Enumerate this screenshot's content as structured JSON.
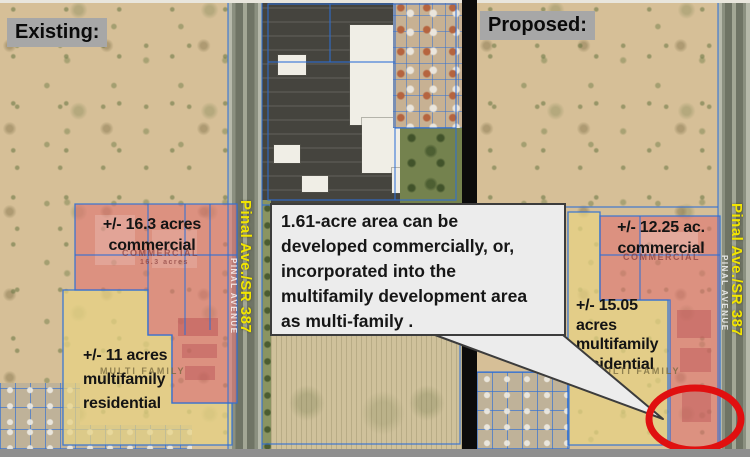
{
  "left_panel": {
    "title": "Existing:",
    "road_label": "Pinal Ave./SR 387",
    "street_label": "PINAL AVENUE",
    "commercial_label": {
      "line1": "+/- 16.3 acres",
      "line2": "commercial"
    },
    "multifamily_label": {
      "line1": "+/- 11 acres",
      "line2": "multifamily",
      "line3": "residential"
    },
    "map_annotations": {
      "commercial": "COMMERCIAL",
      "commercial_acres": "16.3 acres",
      "multifamily": "MULTI FAMILY"
    }
  },
  "right_panel": {
    "title": "Proposed:",
    "road_label": "Pinal Ave./SR 387",
    "street_label": "PINAL AVENUE",
    "commercial_label": {
      "line1": "+/- 12.25 ac.",
      "line2": "commercial"
    },
    "multifamily_label": {
      "line1": "+/- 15.05",
      "line2": "acres",
      "line3": "multifamily",
      "line4": "residential"
    },
    "map_annotations": {
      "commercial": "COMMERCIAL",
      "multifamily": "MULTI FAMILY"
    }
  },
  "callout": {
    "lines": [
      "1.61-acre area can be",
      "developed commercially, or,",
      "incorporated into the",
      "multifamily development area",
      "as multi-family ."
    ]
  },
  "colors": {
    "commercial_overlay": "#e07070",
    "multifamily_overlay": "#e8d382",
    "parcel_line": "#2e6fd6",
    "highlight_circle": "#e01010",
    "road_label_text": "#f2e500",
    "title_background": "#a7a7a7",
    "callout_background": "#ececec"
  }
}
